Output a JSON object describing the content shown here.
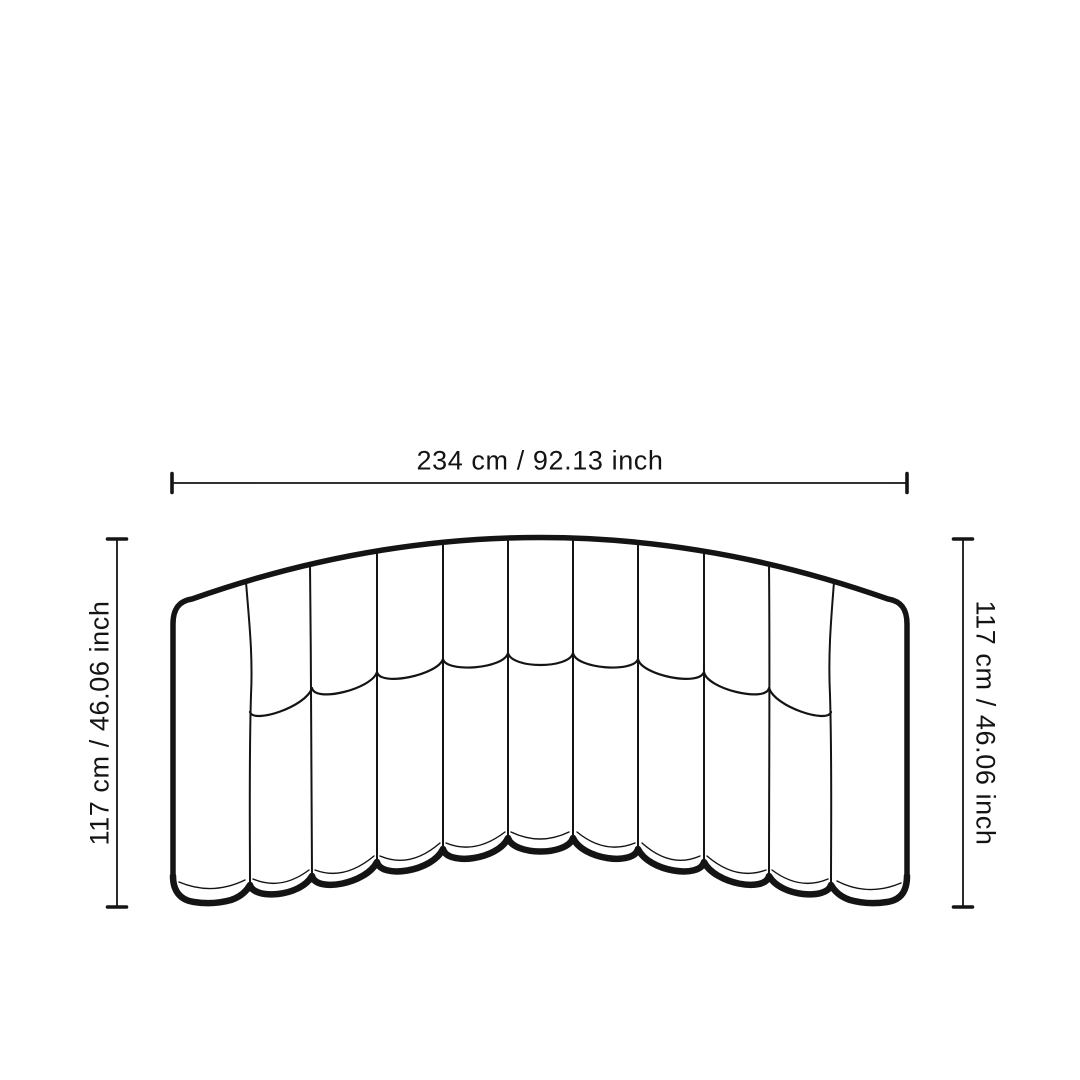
{
  "canvas": {
    "background": "#ffffff",
    "line_color": "#141414"
  },
  "diagram": {
    "subject": "curved-channel-sofa-front-view",
    "width_dimension": {
      "label": "234 cm / 92.13 inch"
    },
    "height_dimension_left": {
      "label": "117 cm / 46.06 inch"
    },
    "height_dimension_right": {
      "label": "117 cm / 46.06 inch"
    },
    "sofa": {
      "channels": 9,
      "arms": 2
    }
  }
}
